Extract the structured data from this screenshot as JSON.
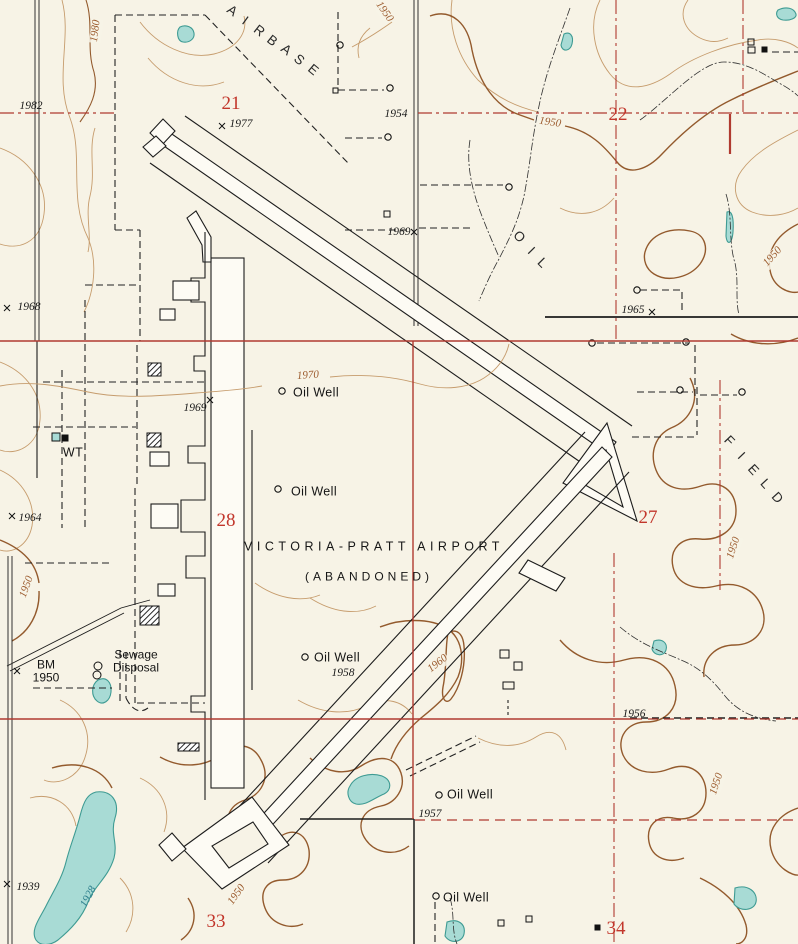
{
  "map": {
    "airport": {
      "name": "VICTORIA-PRATT AIRPORT",
      "status": "(ABANDONED)",
      "name_pos": {
        "x": 374,
        "y": 547
      },
      "status_pos": {
        "x": 369,
        "y": 577
      }
    },
    "area_labels": [
      {
        "word": "AIRBASE",
        "letters": [
          {
            "ch": "A",
            "x": 232,
            "y": 11,
            "rot": 36
          },
          {
            "ch": "I",
            "x": 245,
            "y": 21,
            "rot": 36
          },
          {
            "ch": "R",
            "x": 259,
            "y": 31,
            "rot": 38
          },
          {
            "ch": "B",
            "x": 272,
            "y": 41,
            "rot": 38
          },
          {
            "ch": "A",
            "x": 286,
            "y": 50,
            "rot": 38
          },
          {
            "ch": "S",
            "x": 299,
            "y": 60,
            "rot": 40
          },
          {
            "ch": "E",
            "x": 313,
            "y": 70,
            "rot": 40
          }
        ]
      },
      {
        "word": "OIL",
        "letters": [
          {
            "ch": "O",
            "x": 519,
            "y": 237,
            "rot": 45
          },
          {
            "ch": "I",
            "x": 531,
            "y": 251,
            "rot": 45
          },
          {
            "ch": "L",
            "x": 542,
            "y": 263,
            "rot": 45
          }
        ]
      },
      {
        "word": "FIELD",
        "letters": [
          {
            "ch": "F",
            "x": 729,
            "y": 441,
            "rot": 46
          },
          {
            "ch": "I",
            "x": 741,
            "y": 456,
            "rot": 46
          },
          {
            "ch": "E",
            "x": 753,
            "y": 470,
            "rot": 47
          },
          {
            "ch": "L",
            "x": 765,
            "y": 484,
            "rot": 47
          },
          {
            "ch": "D",
            "x": 777,
            "y": 498,
            "rot": 48
          }
        ]
      }
    ],
    "section_numbers": [
      {
        "text": "21",
        "x": 231,
        "y": 104
      },
      {
        "text": "22",
        "x": 618,
        "y": 115
      },
      {
        "text": "28",
        "x": 226,
        "y": 521
      },
      {
        "text": "27",
        "x": 648,
        "y": 518
      },
      {
        "text": "33",
        "x": 216,
        "y": 922
      },
      {
        "text": "34",
        "x": 616,
        "y": 929
      }
    ],
    "spot_elevations": [
      {
        "text": "1982",
        "x": 31,
        "y": 106
      },
      {
        "text": "1977",
        "x": 241,
        "y": 124
      },
      {
        "text": "1954",
        "x": 396,
        "y": 114
      },
      {
        "text": "1969",
        "x": 399,
        "y": 232
      },
      {
        "text": "1968",
        "x": 29,
        "y": 307
      },
      {
        "text": "1965",
        "x": 633,
        "y": 310
      },
      {
        "text": "1969",
        "x": 195,
        "y": 408
      },
      {
        "text": "1964",
        "x": 30,
        "y": 518
      },
      {
        "text": "1958",
        "x": 343,
        "y": 673
      },
      {
        "text": "1956",
        "x": 634,
        "y": 714
      },
      {
        "text": "1957",
        "x": 430,
        "y": 814
      },
      {
        "text": "1939",
        "x": 28,
        "y": 887
      }
    ],
    "benchmark": {
      "line1": "BM",
      "line2": "1950",
      "x": 46,
      "y": 671
    },
    "contour_labels": [
      {
        "text": "1980",
        "x": 96,
        "y": 31,
        "rot": -83
      },
      {
        "text": "1950",
        "x": 384,
        "y": 12,
        "rot": 55
      },
      {
        "text": "1950",
        "x": 550,
        "y": 123,
        "rot": 8
      },
      {
        "text": "1970",
        "x": 308,
        "y": 376,
        "rot": -4
      },
      {
        "text": "1950",
        "x": 773,
        "y": 257,
        "rot": -48
      },
      {
        "text": "1950",
        "x": 734,
        "y": 548,
        "rot": -72
      },
      {
        "text": "1950",
        "x": 27,
        "y": 587,
        "rot": -70
      },
      {
        "text": "1960",
        "x": 438,
        "y": 664,
        "rot": -38
      },
      {
        "text": "1950",
        "x": 717,
        "y": 784,
        "rot": -72
      },
      {
        "text": "1950",
        "x": 237,
        "y": 895,
        "rot": -55
      }
    ],
    "water_labels": [
      {
        "text": "1928",
        "x": 89,
        "y": 897,
        "rot": -62
      }
    ],
    "feature_labels": [
      {
        "text": "Oil Well",
        "x": 316,
        "y": 393
      },
      {
        "text": "Oil Well",
        "x": 314,
        "y": 492
      },
      {
        "text": "Oil Well",
        "x": 337,
        "y": 658
      },
      {
        "text": "Oil Well",
        "x": 470,
        "y": 795
      },
      {
        "text": "Oil Well",
        "x": 466,
        "y": 898
      },
      {
        "text": "WT",
        "x": 73,
        "y": 453
      }
    ],
    "two_line_labels": [
      {
        "line1": "Sewage",
        "line2": "Disposal",
        "x": 136,
        "y": 661
      }
    ],
    "colors": {
      "background": "#f7f3e6",
      "contour": "#c69c6d",
      "contour_index": "#935a2d",
      "water_fill": "#a8dbd5",
      "water_stroke": "#3e9b93",
      "grid_red": "#b03a30",
      "section_red": "#c2362b",
      "ink": "#1c1c1c"
    }
  }
}
